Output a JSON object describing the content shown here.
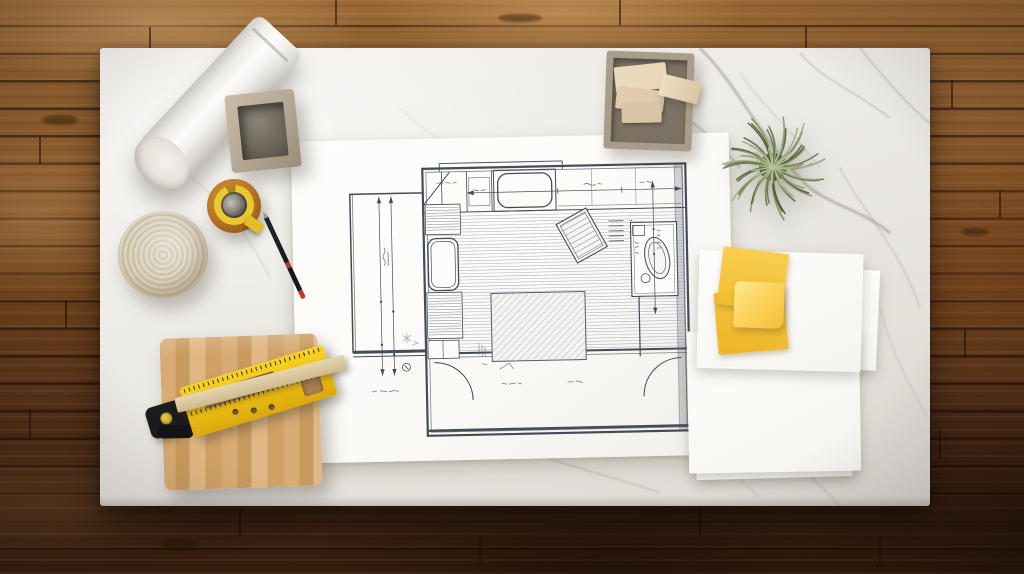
{
  "scene": {
    "description": "Top-down photograph of a white marble desk on a rustic brown wood plank floor. A hand-sketched architectural floor plan lies in the center, surrounded by drafting and building supplies: a rolled sheet of white paper, a square concrete pencil cup, a roll of amber masking tape with a yellow core, a black drafting pencil, a coil of cream rope, a wooden cutting board holding a yellow layout square and a wood straightedge, a tray of wood sample blocks, a green air plant, a stack of white sample cards and yellow sticky notes.",
    "surface_label": "white marble tabletop",
    "floor_label": "brown hardwood plank floor"
  },
  "blueprint": {
    "label": "hand-drawn floor plan sketch on white paper",
    "content": "single-room floor plan with kitchen counter and stove along the top wall, bathtub and shelving on the left wall, bathroom sink unit on the right, tilted rug, large bed drawn over plank flooring hatching, door swing arcs at the bottom, dimension arrows and illegible handwritten dimension notes",
    "annotations_legible": false,
    "paper_color": "#fbfaf7",
    "ink_color": "#454b57"
  },
  "objects": [
    {
      "id": "paper-roll",
      "label": "rolled sheet of white paper",
      "primary_color": "#f3f1ee"
    },
    {
      "id": "square-vessel",
      "label": "square concrete pencil cup",
      "primary_color": "#b3a793"
    },
    {
      "id": "masking-tape",
      "label": "roll of amber masking tape with yellow core",
      "primary_color": "#bc7a24"
    },
    {
      "id": "drafting-pencil",
      "label": "black drafting pencil with red accents",
      "primary_color": "#1b1b1d"
    },
    {
      "id": "rope-coil",
      "label": "coiled cream rope trivet",
      "primary_color": "#ddd5c1"
    },
    {
      "id": "cutting-board",
      "label": "light maple cutting board",
      "primary_color": "#d2a66f"
    },
    {
      "id": "layout-square",
      "label": "yellow layout square tool with black clamp",
      "primary_color": "#f0c315"
    },
    {
      "id": "wood-straightedge",
      "label": "light wood straightedge strip",
      "primary_color": "#d6c39c"
    },
    {
      "id": "samples-tray",
      "label": "square tray of wood sample blocks",
      "primary_color": "#a99d89"
    },
    {
      "id": "air-plant",
      "label": "green air plant",
      "primary_color": "#76855a"
    },
    {
      "id": "card-stack",
      "label": "stack of white sample cards",
      "primary_color": "#fbfaf7"
    },
    {
      "id": "sticky-notes",
      "label": "yellow sticky notes, one curled",
      "primary_color": "#f6c53e"
    }
  ],
  "palette": {
    "marble_base": "#edebe6",
    "marble_vein": "#8d8880",
    "wood_light": "#9a6836",
    "wood_mid": "#8d5c2d",
    "wood_dark": "#3a2110",
    "paper_white": "#fbfaf7",
    "plan_ink": "#454b57",
    "tape_amber": "#bc7a24",
    "tape_yellow": "#e9c832",
    "tool_yellow": "#f0c315",
    "note_yellow": "#f2bd2e",
    "plant_green": "#76855a",
    "board_wood": "#d2a66f",
    "pen_red": "#c8362b",
    "rope_cream": "#ddd5c1",
    "vessel_taupe": "#b3a793",
    "block_cream": "#ead9bb"
  }
}
